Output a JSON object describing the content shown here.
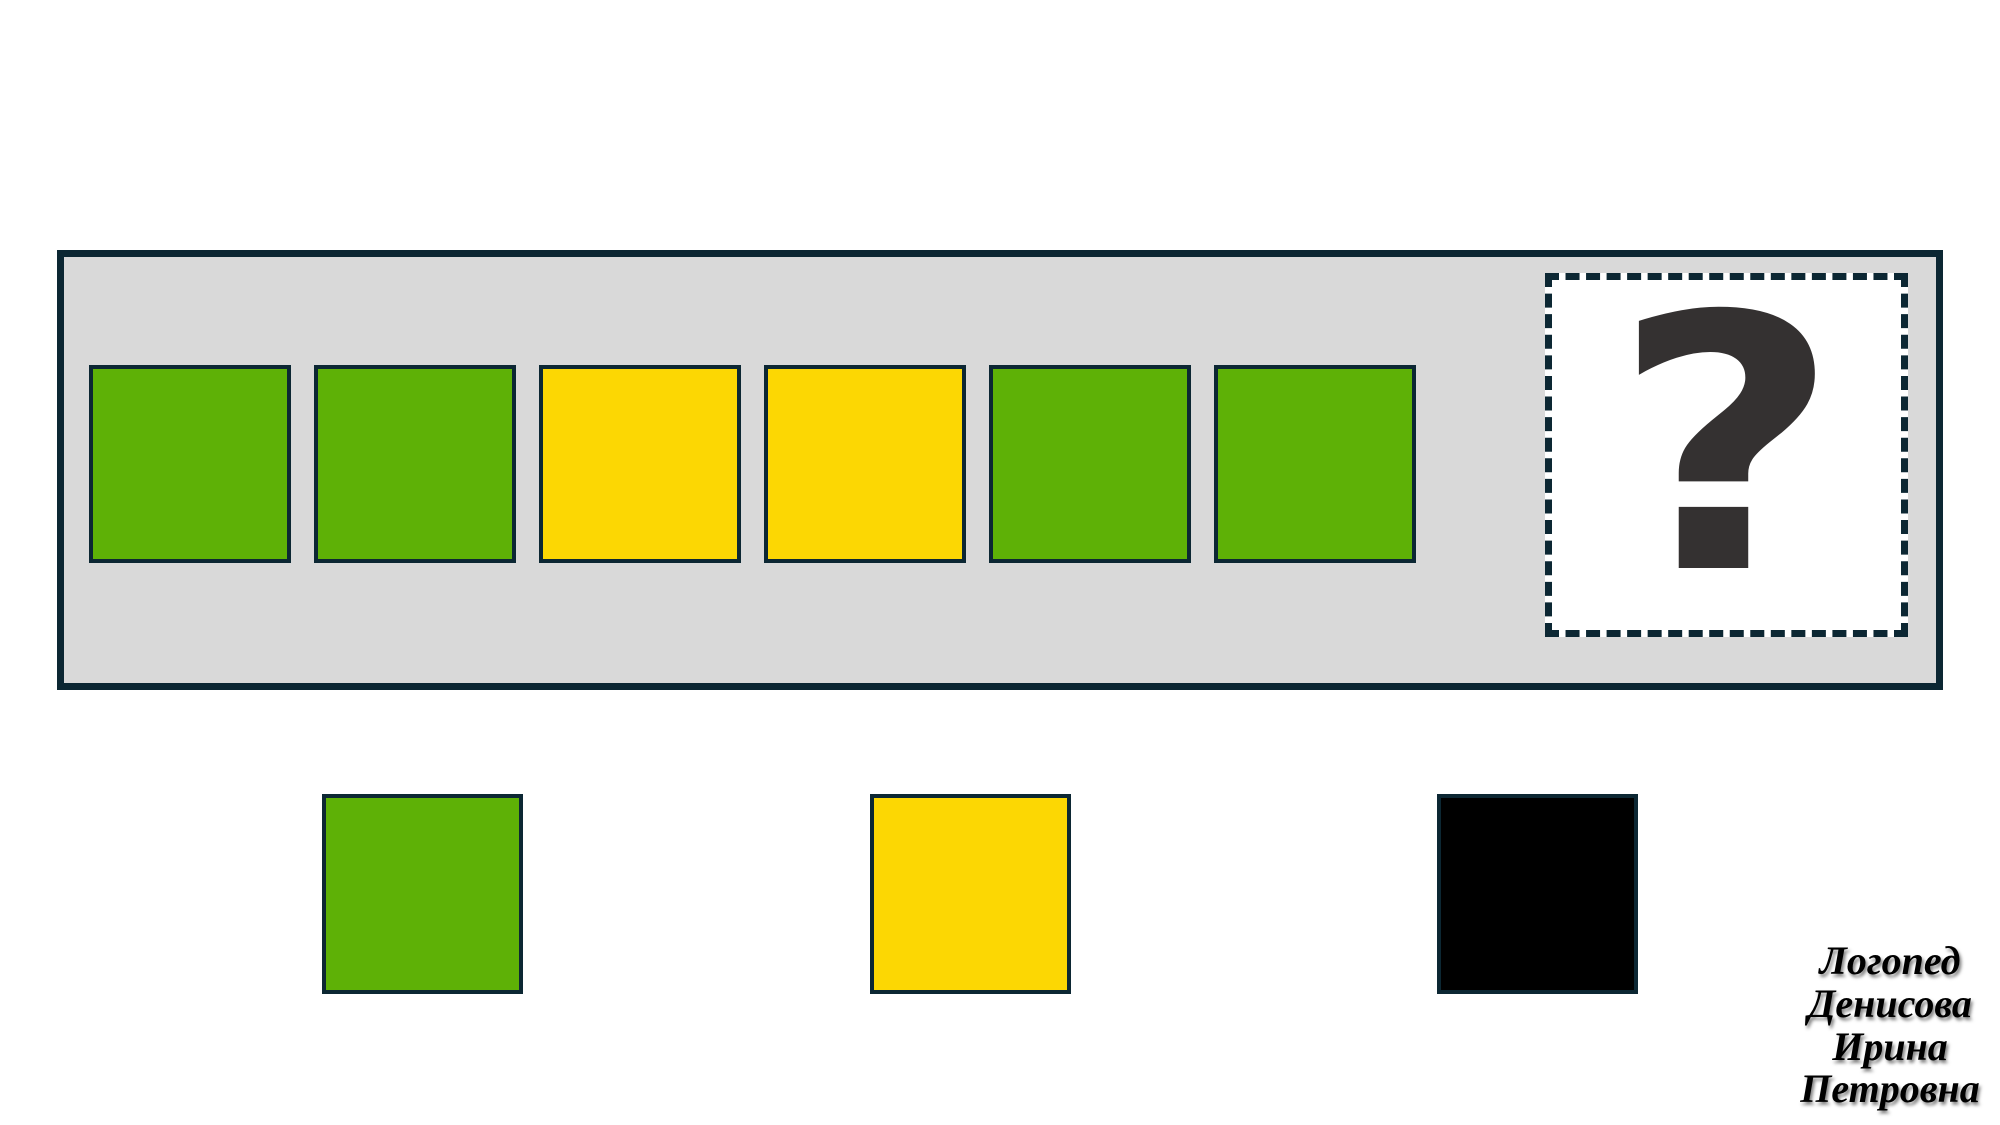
{
  "board": {
    "background": "#d9d9d9",
    "border_color": "#0c2733",
    "sequence": [
      {
        "color_name": "green",
        "hex": "#5eb106"
      },
      {
        "color_name": "green",
        "hex": "#5eb106"
      },
      {
        "color_name": "yellow",
        "hex": "#fcd703"
      },
      {
        "color_name": "yellow",
        "hex": "#fcd703"
      },
      {
        "color_name": "green",
        "hex": "#5eb106"
      },
      {
        "color_name": "green",
        "hex": "#5eb106"
      }
    ],
    "answer_slot": {
      "symbol": "?",
      "background": "#ffffff",
      "symbol_color": "#343131"
    }
  },
  "options": [
    {
      "color_name": "green",
      "hex": "#5eb106"
    },
    {
      "color_name": "yellow",
      "hex": "#fcd703"
    },
    {
      "color_name": "black",
      "hex": "#000000"
    }
  ],
  "watermark": {
    "lines": [
      "Логопед",
      "Денисова",
      "Ирина",
      "Петровна"
    ]
  },
  "colors": {
    "border_dark": "#0c2733",
    "board_gray": "#d9d9d9",
    "question_mark": "#343131",
    "page_background": "#ffffff"
  }
}
